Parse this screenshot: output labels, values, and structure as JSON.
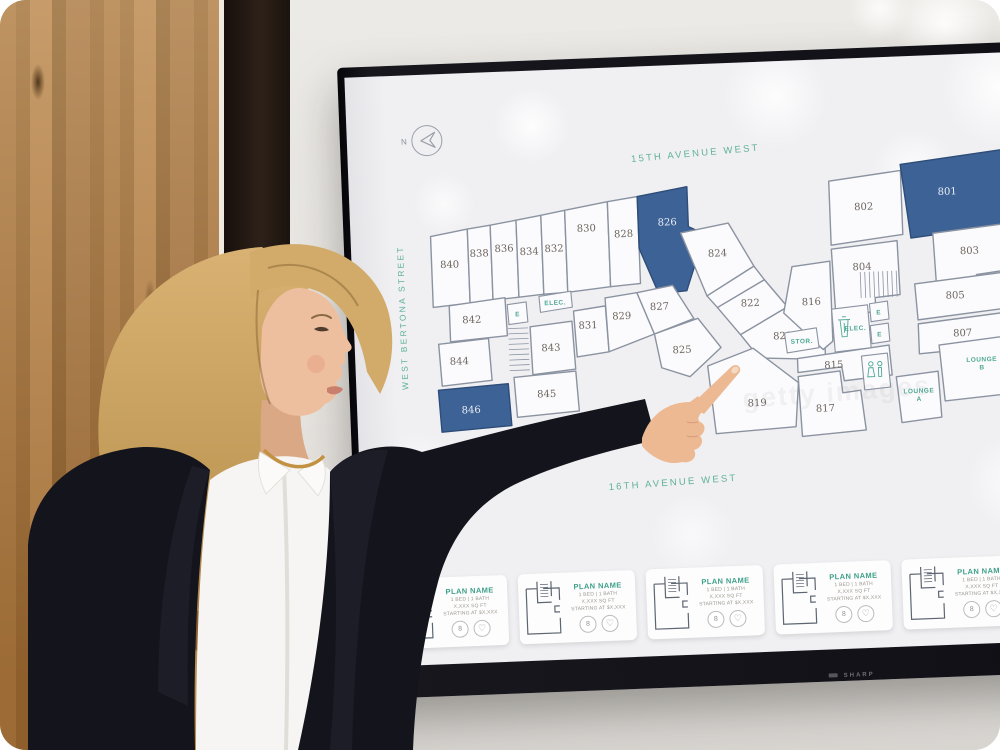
{
  "colors": {
    "accent_teal": "#4EA893",
    "selected_unit_blue": "#3D6295",
    "plan_wall_gray": "#8B93A1"
  },
  "tv": {
    "brand": "SHARP"
  },
  "compass": {
    "label": "N"
  },
  "streets": {
    "top": "15TH AVENUE WEST",
    "left": "WEST BERTONA STREET",
    "bottom": "16TH AVENUE WEST"
  },
  "watermark": "getty images",
  "icons": {
    "heart": "♡"
  },
  "floorplan": {
    "units": [
      {
        "label": "840",
        "poly": "80,162 117,156 117,230 80,233",
        "lx": 98,
        "ly": 194
      },
      {
        "label": "838",
        "poly": "117,156 140,153 140,228 117,230",
        "lx": 128,
        "ly": 184
      },
      {
        "label": "836",
        "poly": "140,153 166,149 166,226 140,228",
        "lx": 153,
        "ly": 180
      },
      {
        "label": "834",
        "poly": "166,149 191,145 191,224 166,226",
        "lx": 178,
        "ly": 184
      },
      {
        "label": "832",
        "poly": "191,145 215,141 215,223 191,224",
        "lx": 203,
        "ly": 182
      },
      {
        "label": "830",
        "poly": "215,141 258,134 258,219 215,223",
        "lx": 236,
        "ly": 163
      },
      {
        "label": "828",
        "poly": "258,134 288,130 288,217 258,219",
        "lx": 273,
        "ly": 170
      },
      {
        "label": "826",
        "poly": "288,130 338,122 338,162 354,170 334,226 306,228 288,182",
        "lx": 317,
        "ly": 160,
        "selected": true
      },
      {
        "label": "824",
        "poly": "330,168 378,160 402,204 354,232",
        "lx": 366,
        "ly": 193
      },
      {
        "label": "",
        "poly": "354,232 402,204 412,218 364,244",
        "lx": 0,
        "ly": 0
      },
      {
        "label": "822",
        "poly": "364,244 412,218 434,246 386,272",
        "lx": 397,
        "ly": 244
      },
      {
        "label": "820",
        "poly": "386,272 434,246 470,282 470,300 404,296",
        "lx": 428,
        "ly": 278
      },
      {
        "label": "816",
        "poly": "440,206 478,202 478,282 468,290 430,252",
        "lx": 458,
        "ly": 245
      },
      {
        "label": "802",
        "poly": "480,122 552,114 552,178 480,186",
        "lx": 514,
        "ly": 152
      },
      {
        "label": "801",
        "poly": "552,108 664,96 666,158 657,160 658,172 560,182",
        "lx": 598,
        "ly": 140,
        "selected": true
      },
      {
        "label": "803",
        "poly": "582,178 666,170 668,216 624,221 624,234 584,238",
        "lx": 618,
        "ly": 200
      },
      {
        "label": "804",
        "poly": "480,190 546,184 547,238 522,240 522,254 482,257",
        "lx": 510,
        "ly": 212
      },
      {
        "label": "805",
        "poly": "562,228 668,218 670,254 564,264",
        "lx": 602,
        "ly": 244
      },
      {
        "label": "807",
        "poly": "564,268 670,258 672,300 596,308 596,296 564,298",
        "lx": 608,
        "ly": 282
      },
      {
        "label": "842",
        "poly": "96,232 152,226 153,264 96,268",
        "lx": 118,
        "ly": 250
      },
      {
        "label": "844",
        "poly": "84,270 134,266 136,308 86,312",
        "lx": 104,
        "ly": 291
      },
      {
        "label": "846",
        "poly": "82,316 152,312 154,354 84,358",
        "lx": 114,
        "ly": 340,
        "selected": true
      },
      {
        "label": "843",
        "poly": "176,256 218,252 220,300 177,304",
        "lx": 196,
        "ly": 281
      },
      {
        "label": "845",
        "poly": "158,306 220,302 222,342 160,346",
        "lx": 190,
        "ly": 327
      },
      {
        "label": "831",
        "poly": "220,242 252,238 254,284 222,288",
        "lx": 234,
        "ly": 260
      },
      {
        "label": "829",
        "poly": "252,230 284,226 300,268 254,284",
        "lx": 268,
        "ly": 252
      },
      {
        "label": "827",
        "poly": "284,226 320,220 340,254 300,268",
        "lx": 306,
        "ly": 244
      },
      {
        "label": "825",
        "poly": "300,268 344,254 366,284 334,312 306,302",
        "lx": 327,
        "ly": 288
      },
      {
        "label": "819",
        "poly": "352,302 398,286 442,322 438,366 358,370",
        "lx": 400,
        "ly": 344
      },
      {
        "label": "817",
        "poly": "442,316 484,312 486,334 504,332 508,372 444,376",
        "lx": 468,
        "ly": 352
      },
      {
        "label": "815",
        "poly": "442,298 534,288 536,318 488,322 486,308 442,312",
        "lx": 478,
        "ly": 309
      },
      {
        "label": "E",
        "poly": "154,233 173,231 174,251 155,253",
        "lx": 164,
        "ly": 245,
        "teal": true,
        "amen": true
      },
      {
        "label": "ELEC.",
        "poly": "186,226 218,222 219,238 187,242",
        "lx": 202,
        "ly": 235,
        "teal": true,
        "amen": true
      },
      {
        "label": "STOR.",
        "poly": "430,272 462,268 464,288 432,292",
        "lx": 447,
        "ly": 283,
        "teal": true,
        "amen": true
      },
      {
        "label": "ELEC.",
        "poly": "478,250 514,247 516,290 480,293",
        "lx": 501,
        "ly": 272,
        "teal": true,
        "amen": true
      },
      {
        "label": "E",
        "poly": "516,246 534,244 535,262 517,264",
        "lx": 525,
        "ly": 257,
        "teal": true,
        "amen": true
      },
      {
        "label": "E",
        "poly": "516,268 534,266 535,284 517,286",
        "lx": 525,
        "ly": 279,
        "teal": true,
        "amen": true
      },
      {
        "label": "",
        "poly": "506,298 532,296 534,330 508,332",
        "lx": 0,
        "ly": 0,
        "amen": true
      },
      {
        "label": "LOUNGE\nA",
        "poly": "540,320 582,316 584,362 544,366",
        "lx": 562,
        "ly": 337,
        "teal": true
      },
      {
        "label": "LOUNGE\nB",
        "poly": "584,290 666,282 668,340 588,346",
        "lx": 626,
        "ly": 308,
        "teal": true
      }
    ],
    "fixtures": [
      {
        "type": "stairs",
        "x": 508,
        "y": 214,
        "w": 36,
        "h": 26,
        "steps": 8,
        "vertical": true
      },
      {
        "type": "stairs",
        "x": 154,
        "y": 257,
        "w": 20,
        "h": 42,
        "steps": 8,
        "vertical": false
      },
      {
        "type": "wc",
        "x": 510,
        "y": 304,
        "w": 20,
        "h": 22
      },
      {
        "type": "trash",
        "x": 484,
        "y": 258,
        "w": 12,
        "h": 20
      }
    ]
  },
  "cards": [
    {
      "plan_name": "PLAN NAME",
      "beds_baths": "1 BED | 1 BATH",
      "sqft": "X,XXX SQ FT",
      "price": "STARTING AT $X,XXX",
      "count_badge": "8"
    },
    {
      "plan_name": "PLAN NAME",
      "beds_baths": "1 BED | 1 BATH",
      "sqft": "X,XXX SQ FT",
      "price": "STARTING AT $X,XXX",
      "count_badge": "8"
    },
    {
      "plan_name": "PLAN NAME",
      "beds_baths": "1 BED | 1 BATH",
      "sqft": "X,XXX SQ FT",
      "price": "STARTING AT $X,XXX",
      "count_badge": "8"
    },
    {
      "plan_name": "PLAN NAME",
      "beds_baths": "1 BED | 1 BATH",
      "sqft": "X,XXX SQ FT",
      "price": "STARTING AT $X,XXX",
      "count_badge": "8"
    },
    {
      "plan_name": "PLAN NAME",
      "beds_baths": "1 BED | 1 BATH",
      "sqft": "X,XXX SQ FT",
      "price": "STARTING AT $X,XXX",
      "count_badge": "8"
    }
  ]
}
